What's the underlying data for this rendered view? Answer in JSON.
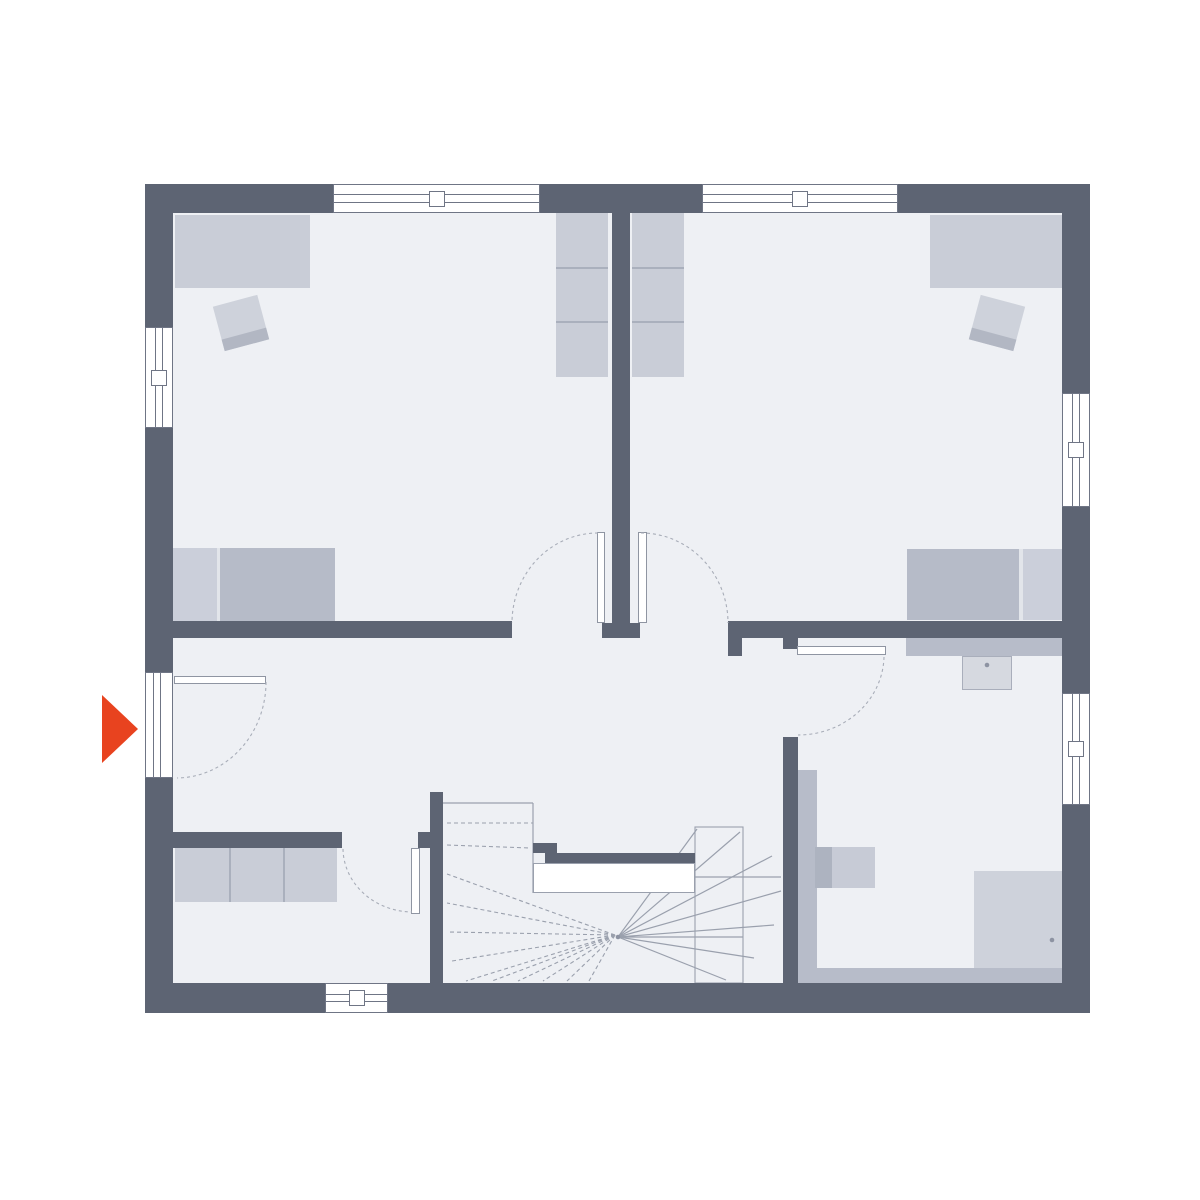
{
  "meta": {
    "label": "floor-plan-upper-storey",
    "canvas_width": 1200,
    "canvas_height": 1200
  },
  "colors": {
    "wall": "#5d6473",
    "floor": "#eef0f4",
    "outside": "#ffffff",
    "furn": "#c9cdd7",
    "furnmid": "#b7bcc9",
    "pillow": "#cbcfda",
    "bedbody": "#b6bbc8",
    "bedgap": "#e2e5ea",
    "chairseat": "#ced2db",
    "chairback": "#b2b7c3",
    "shelfline": "#aab0bd",
    "sinkfill": "#d6d9e0",
    "sinkborder": "#a9aebb",
    "wcleft": "#adb3c0",
    "wcright": "#c7cbd6",
    "shower": "#ced2db",
    "line": "#9aa0ad",
    "frame": "#6f7585",
    "leaf": "#8f95a2",
    "arc": "#a8adb8",
    "dot": "#8d93a2",
    "accent": "#e8431f"
  },
  "floor": {
    "name": "floor-area",
    "x": 173,
    "y": 213,
    "w": 890,
    "h": 770,
    "fill": "floor"
  },
  "walls": [
    {
      "name": "wall-top-left",
      "x": 145,
      "y": 184,
      "w": 188,
      "h": 29
    },
    {
      "name": "wall-top-middle",
      "x": 540,
      "y": 184,
      "w": 162,
      "h": 29
    },
    {
      "name": "wall-top-right",
      "x": 898,
      "y": 184,
      "w": 192,
      "h": 29
    },
    {
      "name": "wall-left-upper",
      "x": 145,
      "y": 184,
      "w": 28,
      "h": 143
    },
    {
      "name": "wall-left-middle",
      "x": 145,
      "y": 428,
      "w": 28,
      "h": 244
    },
    {
      "name": "wall-left-lower",
      "x": 145,
      "y": 778,
      "w": 28,
      "h": 235
    },
    {
      "name": "wall-right-upper",
      "x": 1062,
      "y": 184,
      "w": 28,
      "h": 209
    },
    {
      "name": "wall-right-middle",
      "x": 1062,
      "y": 507,
      "w": 28,
      "h": 186
    },
    {
      "name": "wall-right-lower",
      "x": 1062,
      "y": 805,
      "w": 28,
      "h": 208
    },
    {
      "name": "wall-bottom-left",
      "x": 145,
      "y": 983,
      "w": 180,
      "h": 30
    },
    {
      "name": "wall-bottom-right",
      "x": 388,
      "y": 983,
      "w": 702,
      "h": 30
    },
    {
      "name": "wall-bedroom-divider",
      "x": 612,
      "y": 213,
      "w": 18,
      "h": 410
    },
    {
      "name": "wall-divider-stub",
      "x": 602,
      "y": 623,
      "w": 38,
      "h": 15
    },
    {
      "name": "wall-bedroom-left-south",
      "x": 145,
      "y": 621,
      "w": 367,
      "h": 17
    },
    {
      "name": "wall-hall-south-right",
      "x": 728,
      "y": 621,
      "w": 335,
      "h": 17
    },
    {
      "name": "wall-hall-right-stub",
      "x": 728,
      "y": 638,
      "w": 14,
      "h": 18
    },
    {
      "name": "wall-bath-stub",
      "x": 783,
      "y": 621,
      "w": 15,
      "h": 28
    },
    {
      "name": "wall-bath-left",
      "x": 783,
      "y": 737,
      "w": 15,
      "h": 246
    },
    {
      "name": "wall-stair-left",
      "x": 430,
      "y": 792,
      "w": 13,
      "h": 191
    },
    {
      "name": "wall-storage-north",
      "x": 173,
      "y": 832,
      "w": 169,
      "h": 16
    },
    {
      "name": "wall-storage-stub",
      "x": 418,
      "y": 832,
      "w": 12,
      "h": 16
    }
  ],
  "windows": [
    {
      "name": "window-top-left-room",
      "x": 333,
      "y": 184,
      "w": 207,
      "h": 29,
      "o": "h"
    },
    {
      "name": "window-top-right-room",
      "x": 702,
      "y": 184,
      "w": 196,
      "h": 29,
      "o": "h"
    },
    {
      "name": "window-left-bedroom",
      "x": 145,
      "y": 327,
      "w": 28,
      "h": 101,
      "o": "v"
    },
    {
      "name": "window-right-bedroom",
      "x": 1062,
      "y": 393,
      "w": 28,
      "h": 114,
      "o": "v"
    },
    {
      "name": "window-right-bathroom",
      "x": 1062,
      "y": 693,
      "w": 28,
      "h": 112,
      "o": "v"
    },
    {
      "name": "window-bottom-storage",
      "x": 325,
      "y": 983,
      "w": 63,
      "h": 30,
      "o": "h"
    },
    {
      "name": "entrance-door-opening",
      "x": 145,
      "y": 672,
      "w": 28,
      "h": 106,
      "o": "v",
      "opening": true
    }
  ],
  "door_leaves": [
    {
      "name": "door-leaf-entrance",
      "x": 174,
      "y": 676,
      "w": 92,
      "h": 8
    },
    {
      "name": "door-leaf-bedroom-left",
      "x": 597,
      "y": 532,
      "w": 8,
      "h": 91
    },
    {
      "name": "door-leaf-bedroom-right",
      "x": 638,
      "y": 532,
      "w": 9,
      "h": 91
    },
    {
      "name": "door-leaf-storage",
      "x": 411,
      "y": 848,
      "w": 9,
      "h": 66
    },
    {
      "name": "door-leaf-bathroom",
      "x": 797,
      "y": 646,
      "w": 89,
      "h": 9
    }
  ],
  "door_arcs": [
    {
      "name": "door-swing-entrance",
      "d": "M 266 682 A 90 96 0 0 1 177 778"
    },
    {
      "name": "door-swing-bedroom-left",
      "d": "M 598 533 A 86 90 0 0 0 512 623"
    },
    {
      "name": "door-swing-bedroom-right",
      "d": "M 641 533 A 87 90 0 0 1 728 623"
    },
    {
      "name": "door-swing-storage",
      "d": "M 343 849 A 70 64 0 0 0 412 912"
    },
    {
      "name": "door-swing-bathroom",
      "d": "M 884 657 A 86 80 0 0 1 798 735"
    }
  ],
  "furniture": [
    {
      "name": "desk-bedroom-left",
      "x": 175,
      "y": 215,
      "w": 135,
      "h": 73,
      "fill": "furn"
    },
    {
      "name": "chair-bedroom-left",
      "x": 218,
      "y": 300,
      "w": 46,
      "h": 46,
      "fill": "chairseat",
      "rotate": -15,
      "children": [
        {
          "name": "chair-backrest",
          "x": 0,
          "y": 34,
          "w": 46,
          "h": 12,
          "fill": "chairback"
        }
      ]
    },
    {
      "name": "bed-bedroom-left",
      "x": 171,
      "y": 548,
      "w": 164,
      "h": 73,
      "fill": "bedgap",
      "children": [
        {
          "name": "bed-pillow",
          "x": 0,
          "y": 0,
          "w": 46,
          "h": 73,
          "fill": "pillow"
        },
        {
          "name": "bed-body",
          "x": 49,
          "y": 0,
          "w": 115,
          "h": 73,
          "fill": "bedbody"
        }
      ]
    },
    {
      "name": "shelf-left-of-divider",
      "x": 556,
      "y": 213,
      "w": 52,
      "h": 164,
      "fill": "furn",
      "children": [
        {
          "name": "shelf-divider",
          "x": 0,
          "y": 54,
          "w": 52,
          "h": 2,
          "fill": "shelfline"
        },
        {
          "name": "shelf-divider",
          "x": 0,
          "y": 108,
          "w": 52,
          "h": 2,
          "fill": "shelfline"
        }
      ]
    },
    {
      "name": "shelf-right-of-divider",
      "x": 632,
      "y": 213,
      "w": 52,
      "h": 164,
      "fill": "furn",
      "children": [
        {
          "name": "shelf-divider",
          "x": 0,
          "y": 54,
          "w": 52,
          "h": 2,
          "fill": "shelfline"
        },
        {
          "name": "shelf-divider",
          "x": 0,
          "y": 108,
          "w": 52,
          "h": 2,
          "fill": "shelfline"
        }
      ]
    },
    {
      "name": "desk-bedroom-right",
      "x": 930,
      "y": 215,
      "w": 133,
      "h": 73,
      "fill": "furn"
    },
    {
      "name": "chair-bedroom-right",
      "x": 974,
      "y": 300,
      "w": 46,
      "h": 46,
      "fill": "chairseat",
      "rotate": 15,
      "children": [
        {
          "name": "chair-backrest",
          "x": 0,
          "y": 34,
          "w": 46,
          "h": 12,
          "fill": "chairback"
        }
      ]
    },
    {
      "name": "bed-bedroom-right",
      "x": 907,
      "y": 549,
      "w": 156,
      "h": 71,
      "fill": "bedgap",
      "children": [
        {
          "name": "bed-body",
          "x": 0,
          "y": 0,
          "w": 112,
          "h": 71,
          "fill": "bedbody"
        },
        {
          "name": "bed-pillow",
          "x": 116,
          "y": 0,
          "w": 40,
          "h": 71,
          "fill": "pillow"
        }
      ]
    },
    {
      "name": "sideboard-storage",
      "x": 175,
      "y": 848,
      "w": 162,
      "h": 54,
      "fill": "furn",
      "children": [
        {
          "name": "sideboard-divider",
          "x": 54,
          "y": 0,
          "w": 2,
          "h": 54,
          "fill": "shelfline"
        },
        {
          "name": "sideboard-divider",
          "x": 108,
          "y": 0,
          "w": 2,
          "h": 54,
          "fill": "shelfline"
        }
      ]
    },
    {
      "name": "bathroom-vanity-counter",
      "x": 906,
      "y": 638,
      "w": 157,
      "h": 18,
      "fill": "furnmid"
    },
    {
      "name": "bathroom-sink",
      "x": 962,
      "y": 656,
      "w": 50,
      "h": 34,
      "fill": "sinkfill",
      "border": "sinkborder"
    },
    {
      "name": "bathroom-install-wall-vertical",
      "x": 798,
      "y": 770,
      "w": 19,
      "h": 198,
      "fill": "furnmid"
    },
    {
      "name": "bathroom-toilet",
      "x": 815,
      "y": 847,
      "w": 60,
      "h": 41,
      "fill": "wcright",
      "children": [
        {
          "name": "toilet-tank",
          "x": 0,
          "y": 0,
          "w": 17,
          "h": 41,
          "fill": "wcleft"
        }
      ]
    },
    {
      "name": "bathroom-install-wall-bottom",
      "x": 798,
      "y": 968,
      "w": 265,
      "h": 15,
      "fill": "furnmid"
    },
    {
      "name": "bathroom-shower",
      "x": 974,
      "y": 871,
      "w": 89,
      "h": 97,
      "fill": "shower"
    }
  ],
  "stairs": {
    "name": "staircase",
    "solid": [
      [
        443,
        803,
        533,
        803
      ],
      [
        533,
        803,
        533,
        893
      ],
      [
        618,
        937,
        743,
        937
      ],
      [
        695,
        877,
        781,
        877
      ],
      [
        618,
        937,
        697,
        829
      ],
      [
        618,
        937,
        740,
        832
      ],
      [
        618,
        937,
        772,
        856
      ],
      [
        618,
        937,
        781,
        891
      ],
      [
        618,
        937,
        774,
        925
      ],
      [
        618,
        937,
        754,
        958
      ],
      [
        618,
        937,
        726,
        980
      ]
    ],
    "dashed": [
      [
        447,
        823,
        533,
        823
      ],
      [
        447,
        845,
        531,
        848
      ],
      [
        615,
        935,
        447,
        874
      ],
      [
        615,
        935,
        447,
        903
      ],
      [
        615,
        935,
        448,
        932
      ],
      [
        615,
        935,
        452,
        961
      ],
      [
        615,
        935,
        466,
        981
      ],
      [
        615,
        935,
        492,
        981
      ],
      [
        615,
        935,
        518,
        981
      ],
      [
        615,
        935,
        543,
        981
      ],
      [
        615,
        935,
        567,
        981
      ],
      [
        615,
        935,
        589,
        981
      ]
    ],
    "outlines": [
      {
        "name": "stair-flight-outline",
        "x": 695,
        "y": 827,
        "w": 48,
        "h": 156
      }
    ],
    "rects": [
      {
        "name": "stairwell-stub",
        "x": 533,
        "y": 843,
        "w": 24,
        "h": 10,
        "fill": "wall"
      },
      {
        "name": "stairwell-edge-bar",
        "x": 545,
        "y": 853,
        "w": 150,
        "h": 10,
        "fill": "wall"
      },
      {
        "name": "stairwell-void",
        "x": 533,
        "y": 863,
        "w": 162,
        "h": 30,
        "fill": "#ffffff",
        "border": "line"
      }
    ],
    "dots": [
      [
        618,
        937
      ]
    ]
  },
  "fixture_dots": [
    [
      987,
      665
    ],
    [
      1052,
      940
    ]
  ],
  "entrance_arrow": {
    "name": "entrance-arrow",
    "points": "102,695 138,729 102,763",
    "fill": "accent"
  }
}
